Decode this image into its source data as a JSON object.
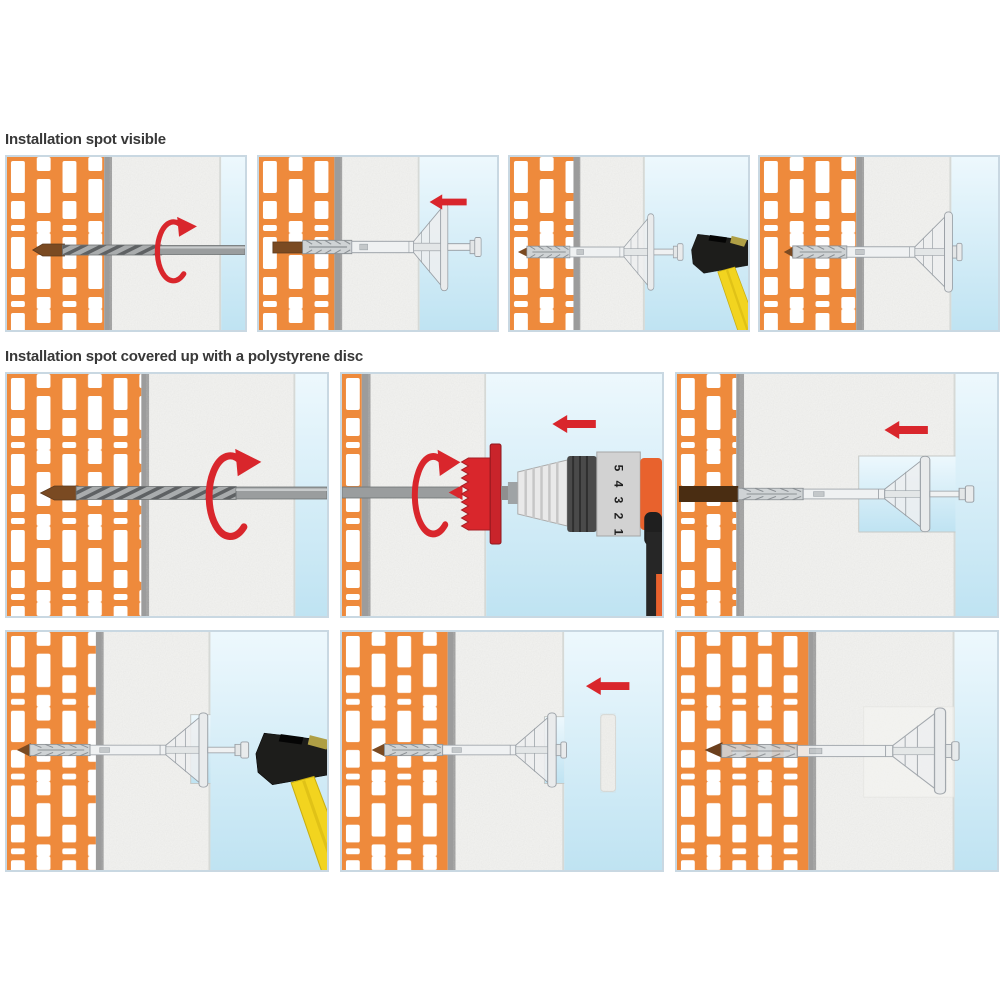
{
  "page": {
    "background": "#FFFFFF"
  },
  "sections": [
    {
      "title": "Installation spot visible"
    },
    {
      "title": "Installation spot covered up with a polystyrene disc"
    }
  ],
  "drill": {
    "clutch_numbers": [
      "5",
      "4",
      "3",
      "2",
      "1"
    ]
  },
  "colors": {
    "brick_orange": "#EE8A3C",
    "mortar_white": "#FFFFFF",
    "adhesive_gray": "#9C9C9C",
    "insulation_white": "#F3F3F1",
    "sky_light": "#EDF8FD",
    "sky_deep": "#BFE3F2",
    "accent_red": "#D9262C",
    "drill_hole_brown": "#7A4A22",
    "deep_hole_brown": "#4A2D12",
    "anchor_gray": "#E9EBEC",
    "hammer_head_black": "#1D1D1B",
    "hammer_handle_yellow": "#F2D41F",
    "drill_body_orange": "#E8622D",
    "metal_gray": "#9A9D9E"
  }
}
